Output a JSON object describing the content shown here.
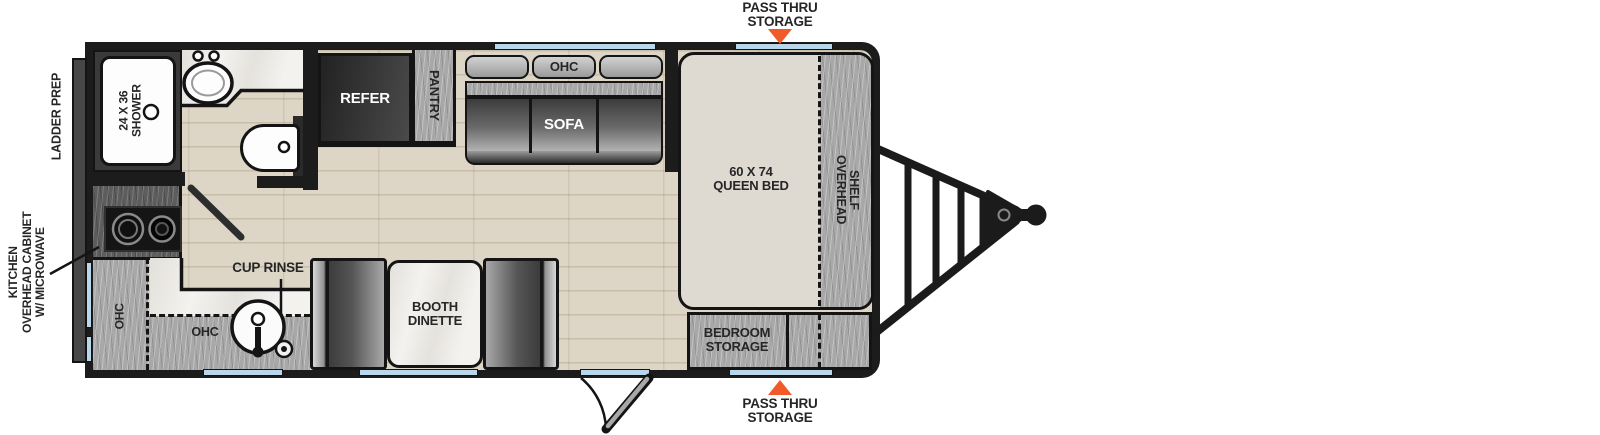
{
  "plan_type": "travel-trailer-floorplan",
  "labels": {
    "ladder_prep": "LADDER PREP",
    "kitchen_overhead_cabinet": "KITCHEN\nOVERHEAD CABINET\nW/ MICROWAVE",
    "shower": "24 X 36\nSHOWER",
    "refer": "REFER",
    "pantry": "PANTRY",
    "sofa_ohc": "OHC",
    "sofa": "SOFA",
    "pass_thru_top": "PASS THRU\nSTORAGE",
    "pass_thru_bottom": "PASS THRU\nSTORAGE",
    "queen_bed": "60 X 74\nQUEEN BED",
    "overhead_shelf": "OVERHEAD\nSHELF",
    "bedroom_storage": "BEDROOM\nSTORAGE",
    "cup_rinse": "CUP RINSE",
    "kitchen_ohc_left": "OHC",
    "kitchen_ohc_bottom": "OHC",
    "booth_dinette": "BOOTH\nDINETTE"
  },
  "colors": {
    "wall": "#1c1c1c",
    "floor_wood": "#ddd5c6",
    "counter_gray": "#a8a8a8",
    "marble": "#f4f2ef",
    "bed_cream": "#dedad1",
    "window_blue": "#b9d6ea",
    "arrow_orange": "#f15a29",
    "appliance_dark": "#2e2e2e"
  }
}
